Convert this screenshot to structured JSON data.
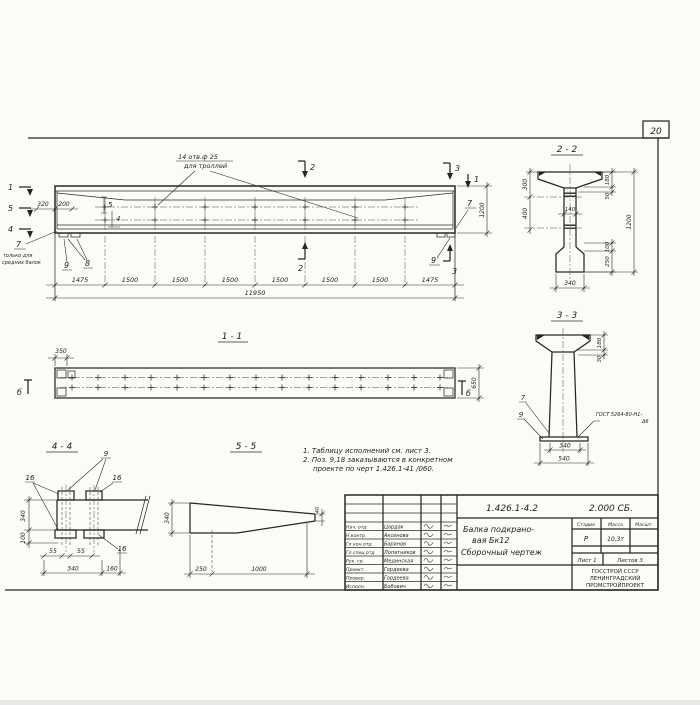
{
  "page": {
    "number": "20"
  },
  "elevation": {
    "hole_note_line1": "14 отв.ф 25",
    "hole_note_line2": "для троллей",
    "cut1_left": "1",
    "cut5_left": "5",
    "cut4_left": "4",
    "cut1_right": "1",
    "cut2_top": "2",
    "cut2_bottom": "2",
    "cut3_top": "3",
    "cut3_bottom": "3",
    "pos5": "5",
    "pos4": "4",
    "pos7_left": "7",
    "pos7_note1": "только для",
    "pos7_note2": "средних балок",
    "pos9_left": "9",
    "pos8": "8",
    "pos7_right": "7",
    "pos9_right": "9",
    "dim_320": "320",
    "dim_200": "200",
    "dim_1200": "1200",
    "dims_bottom": [
      "1475",
      "1500",
      "1500",
      "1500",
      "1500",
      "1500",
      "1500",
      "1475"
    ],
    "dim_total": "11950"
  },
  "view11": {
    "title": "1 - 1",
    "dim_350": "350",
    "dim_650": "650",
    "mark_left": "б",
    "mark_right": "б"
  },
  "view44": {
    "title": "4 - 4",
    "pos9": "9",
    "pos16_left": "16",
    "pos16_right": "16",
    "pos16_bottom": "16",
    "dim_340_side": "340",
    "dim_100": "100",
    "dim_55_first": "55",
    "dim_55_second": "55",
    "dim_340_bottom": "340",
    "dim_160": "160"
  },
  "view55": {
    "title": "5 - 5",
    "dim_340": "340",
    "dim_250": "250",
    "dim_1000": "1000",
    "dim_40": "40"
  },
  "section22": {
    "title": "2 - 2",
    "dim_300": "300",
    "dim_400": "400",
    "dim_140": "140",
    "dim_180": "180",
    "dim_50": "50",
    "dim_1200": "1200",
    "dim_100": "100",
    "dim_250": "250",
    "dim_340": "340"
  },
  "section33": {
    "title": "3 - 3",
    "dim_180": "180",
    "dim_30": "30",
    "pos7": "7",
    "pos9": "9",
    "weld_line1": "ГОСТ 5264-80-Н1-",
    "weld_line2": "Δ6",
    "dim_340": "340",
    "dim_540": "540"
  },
  "notes": {
    "line1": "1. Таблицу исполнений см. лист 3.",
    "line2": "2. Поз. 9,18 заказываются в конкретном",
    "line3": "проекте по черт 1.426.1-41 /060."
  },
  "titleblock": {
    "doc_number": "1.426.1-4.2",
    "doc_code": "2.000 СБ.",
    "title_line1": "Балка подкрано-",
    "title_line2": "вая Бк12",
    "title_line3": "Сборочный  чертеж",
    "col_stage": "Стадия",
    "col_mass": "Масса",
    "col_scale": "Масшт.",
    "stage_value": "Р",
    "mass_value": "10,3т",
    "scale_value": "",
    "sheet_label": "Лист 1",
    "sheets_label": "Листов 3",
    "org_line1": "ГОССТРОЙ СССР",
    "org_line2": "ЛЕНИНГРАДСКИЙ",
    "org_line3": "ПРОМСТРОЙПРОЕКТ",
    "rows": [
      {
        "role": "Нач. отд",
        "name": "Цардак"
      },
      {
        "role": "Н.контр.",
        "name": "Аксенова"
      },
      {
        "role": "Гл.кон.отд",
        "name": "Баранов"
      },
      {
        "role": "Гл.спец.отд",
        "name": "Лопатников"
      },
      {
        "role": "Рук. гр.",
        "name": "Мединская"
      },
      {
        "role": "Проект.",
        "name": "Гордеева"
      },
      {
        "role": "Провер.",
        "name": "Гордеева"
      },
      {
        "role": "Исполн.",
        "name": "Бобович"
      }
    ]
  }
}
